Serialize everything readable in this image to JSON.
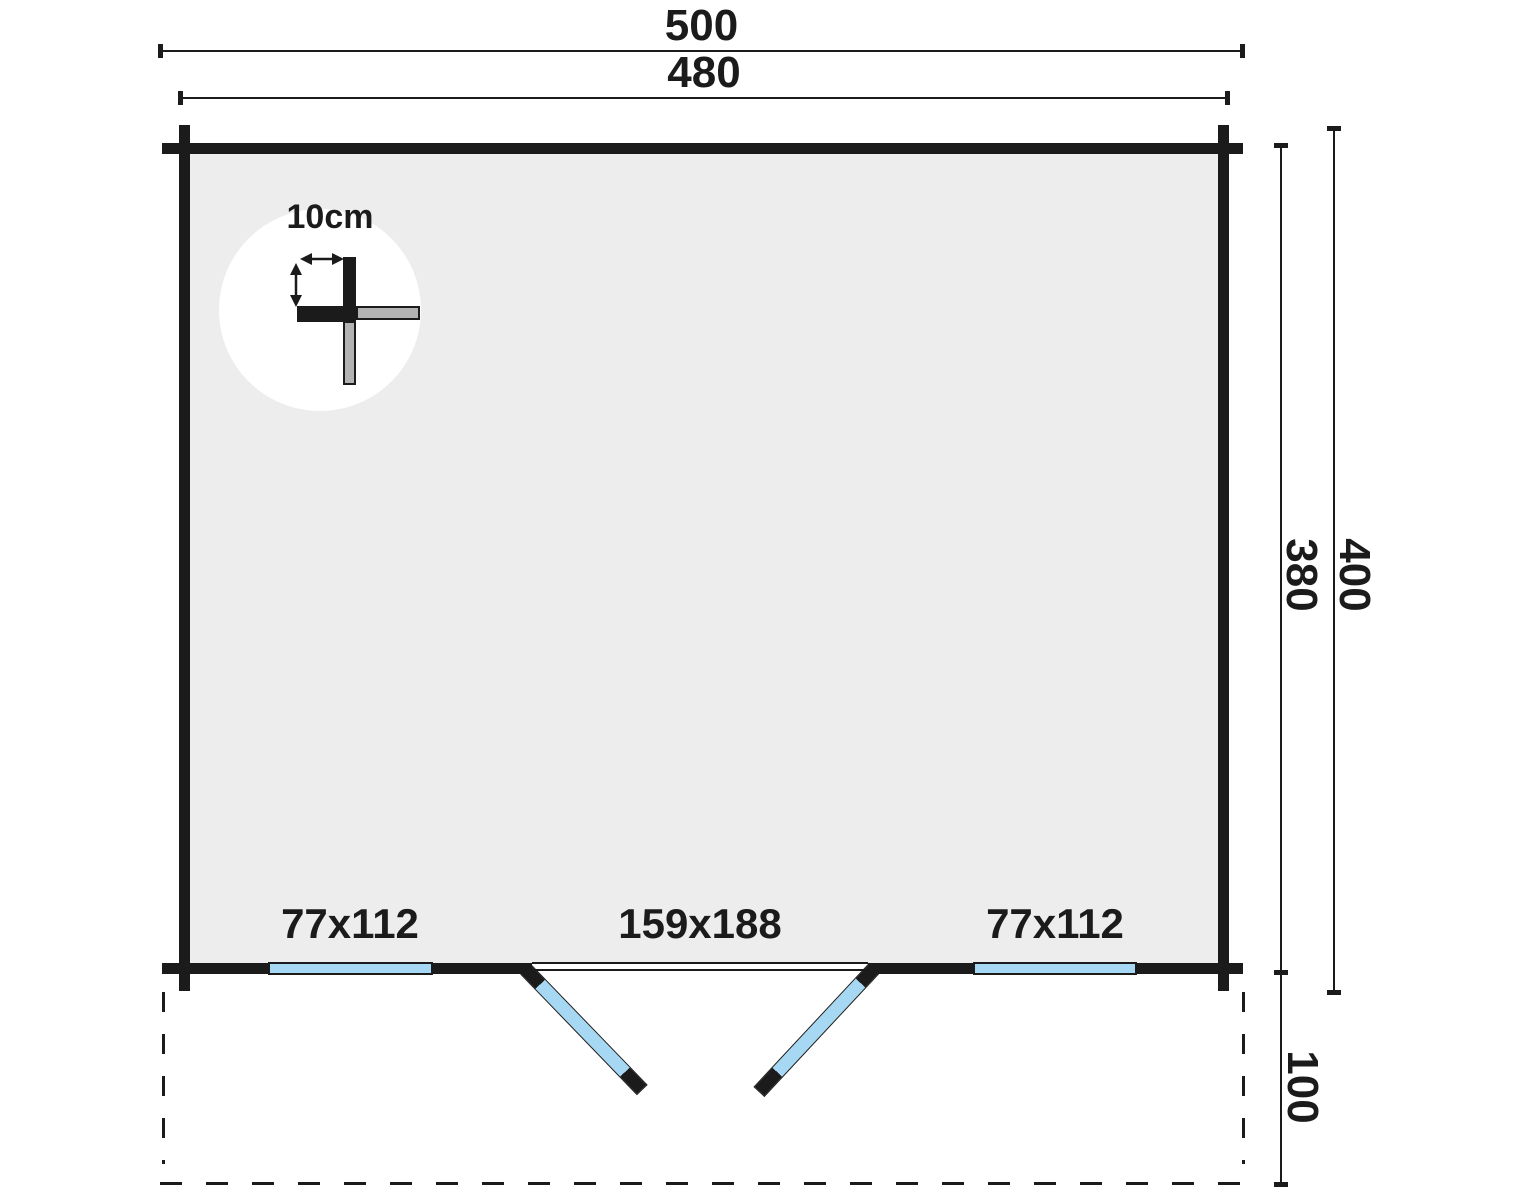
{
  "diagram": {
    "dimensions": {
      "top_outer": "500",
      "top_inner": "480",
      "right_inner": "380",
      "right_outer": "400",
      "porch_depth": "100"
    },
    "wall_detail": {
      "thickness_label": "10cm"
    },
    "openings": {
      "left_window": "77x112",
      "double_door": "159x188",
      "right_window": "77x112"
    },
    "colors": {
      "wall_black": "#1b1b1b",
      "interior_gray": "#ededed",
      "glass_blue": "#a6d8f3",
      "log_gray": "#b3b3b3",
      "background": "#ffffff"
    }
  }
}
